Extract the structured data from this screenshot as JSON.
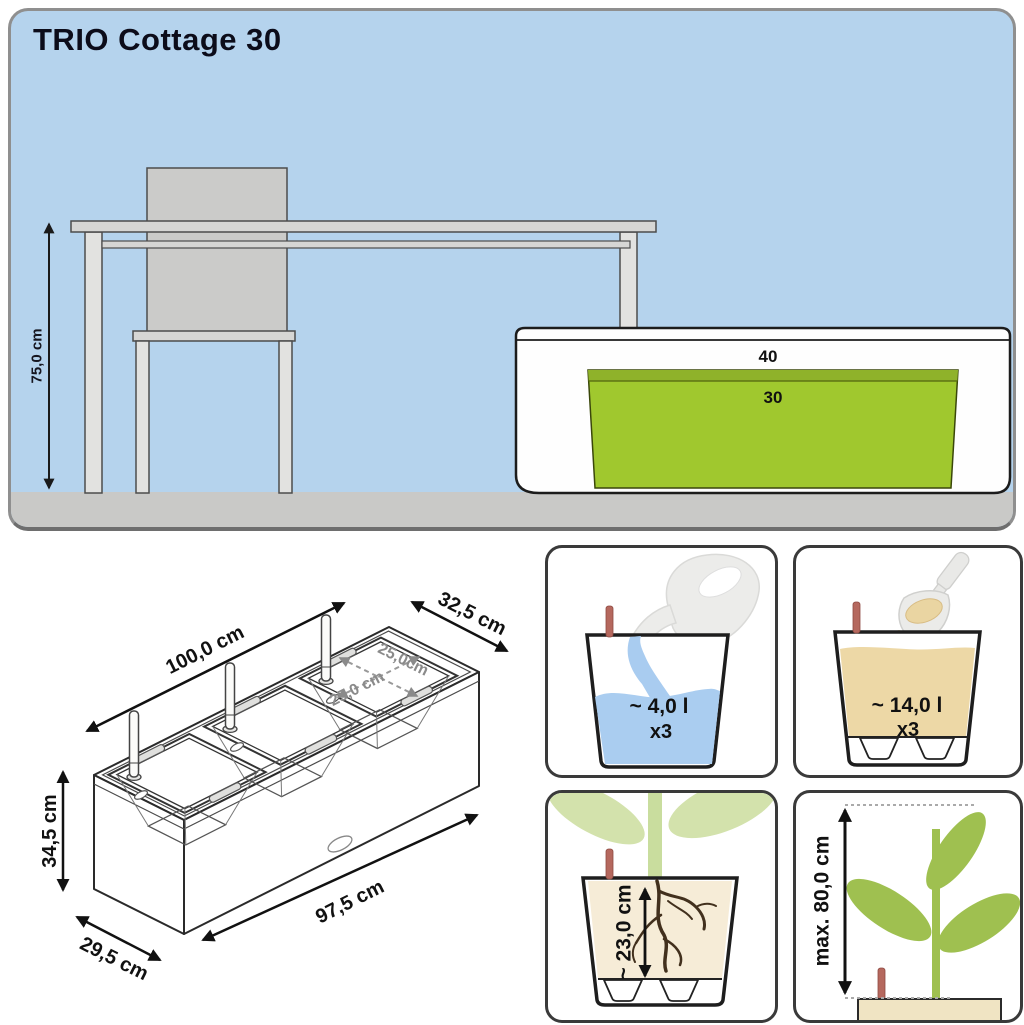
{
  "title": "TRIO Cottage 30",
  "scene": {
    "height_label": "75,0 cm",
    "planter_outer_label": "40",
    "planter_inner_label": "30"
  },
  "iso_diagram": {
    "length_label": "100,0 cm",
    "depth_label": "32,5 cm",
    "opening_width_label": "25,0 cm",
    "opening_depth_label": "25,0cm",
    "height_label": "34,5 cm",
    "base_length_label": "97,5 cm",
    "base_depth_label": "29,5 cm"
  },
  "panels": {
    "water": {
      "value": "~ 4,0 l",
      "multiplier": "x3"
    },
    "substrate": {
      "value": "~ 14,0 l",
      "multiplier": "x3"
    },
    "root_depth": {
      "value": "~ 23,0 cm"
    },
    "plant_height": {
      "value": "max. 80,0 cm"
    }
  },
  "colors": {
    "sky": "#b5d3ed",
    "floor": "#c9c9c7",
    "planter_green": "#a0c82e",
    "water_blue": "#aacdf0",
    "substrate_tan": "#edd8a6",
    "leaf_green": "#9fc050",
    "pale_leaf_green": "#d3e2ac",
    "indicator_red": "#b5685e"
  }
}
